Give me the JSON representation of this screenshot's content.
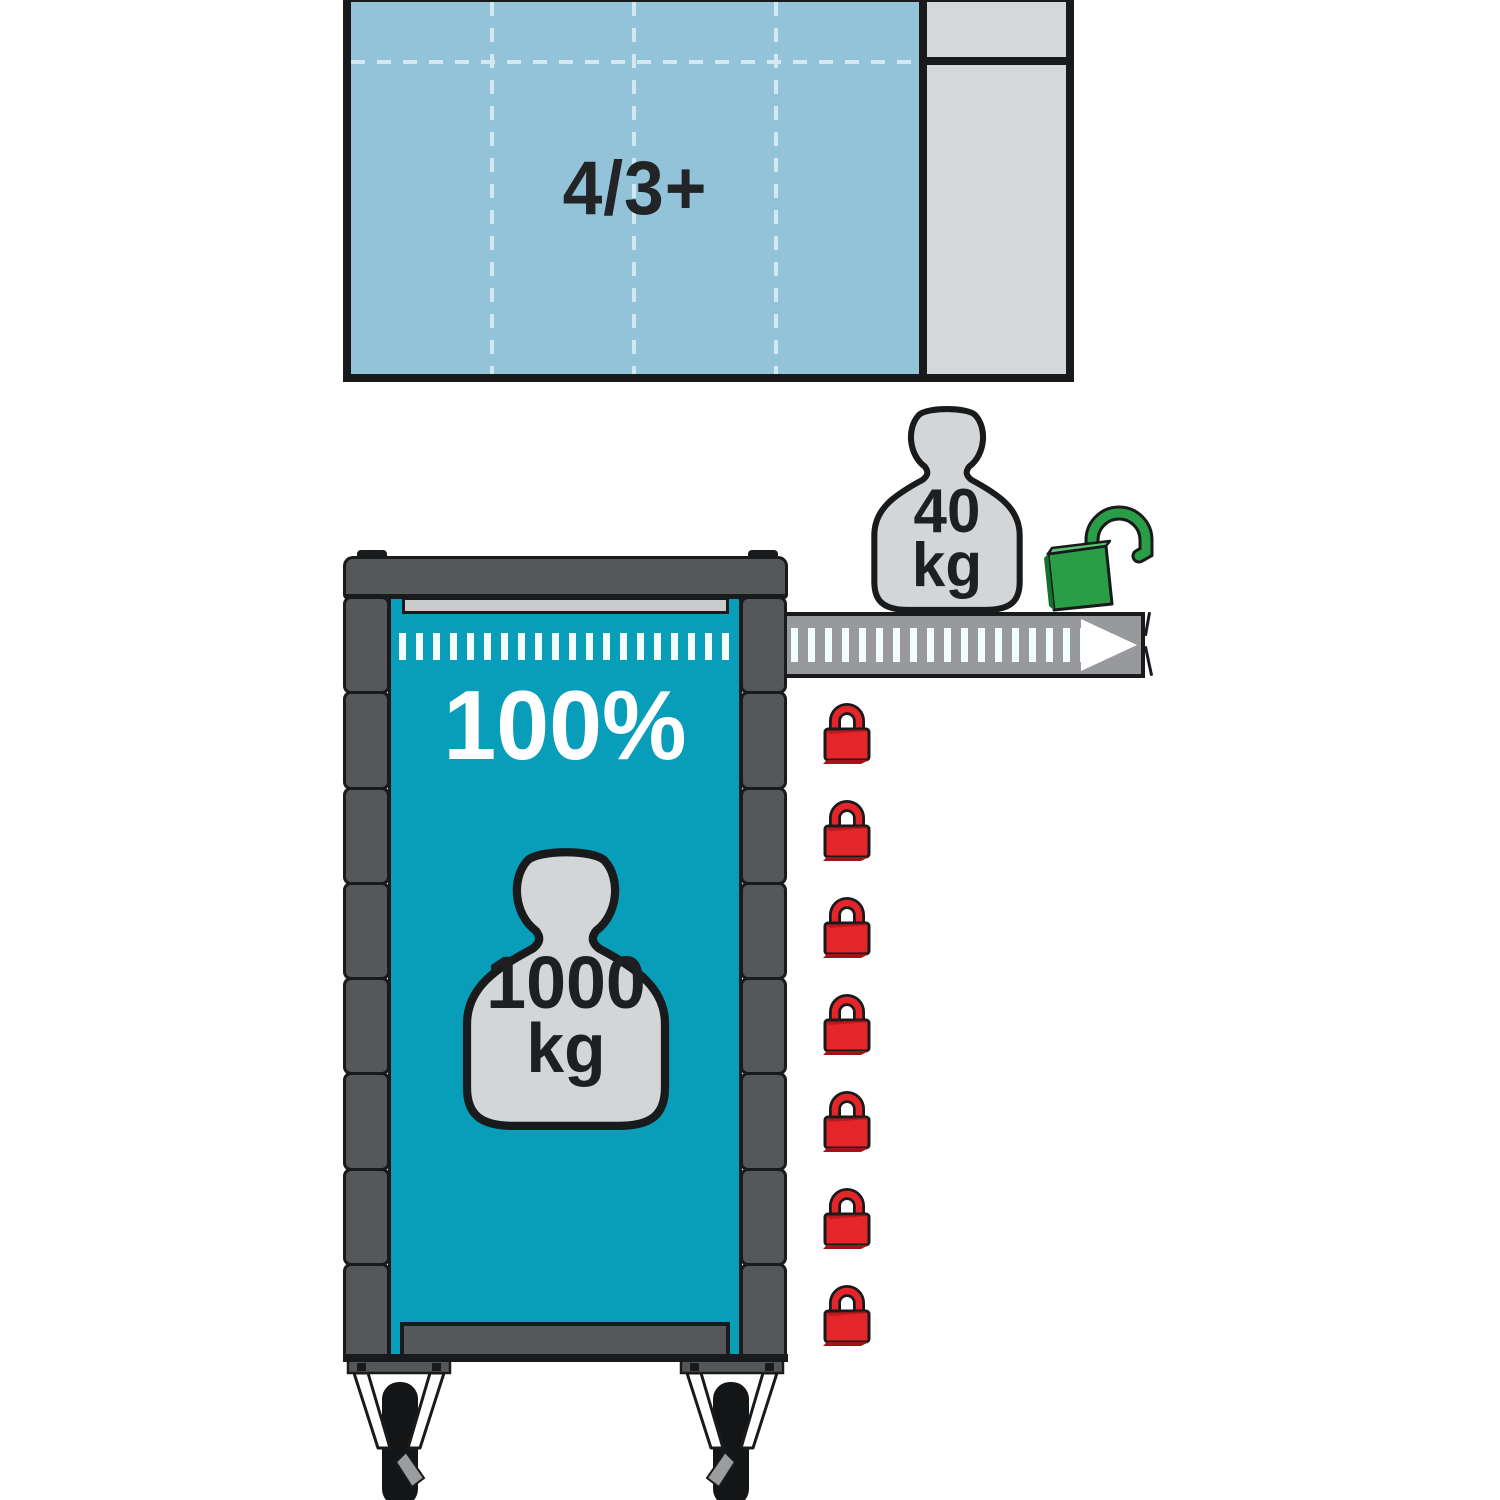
{
  "illustration": {
    "top_panel": {
      "label": "4/3+"
    },
    "open_drawer": {
      "weight_value": "40",
      "weight_unit": "kg",
      "lock_state_icon": "open-padlock-green"
    },
    "trolley": {
      "extension_label": "100%",
      "weight_value": "1000",
      "weight_unit": "kg",
      "drawer_count": 7
    },
    "locked_drawers": {
      "count": 7,
      "lock_state_icon": "closed-padlock-red"
    }
  },
  "colors": {
    "teal": "#089db9",
    "teal-light": "#92c3d8",
    "grid-dash": "#d3e8f1",
    "panel-gray": "#d5d7d8",
    "frame": "#565759",
    "outline": "#181a1b",
    "drawer-gray": "#98999c",
    "strip": "#c9cbcd",
    "weight-gray": "#d4d5d6",
    "lock-red": "#e42529",
    "lock-red-dark": "#a01317",
    "lock-green": "#2a9e47",
    "lock-green-light": "#5cc277",
    "lock-green-dark": "#13732e"
  }
}
